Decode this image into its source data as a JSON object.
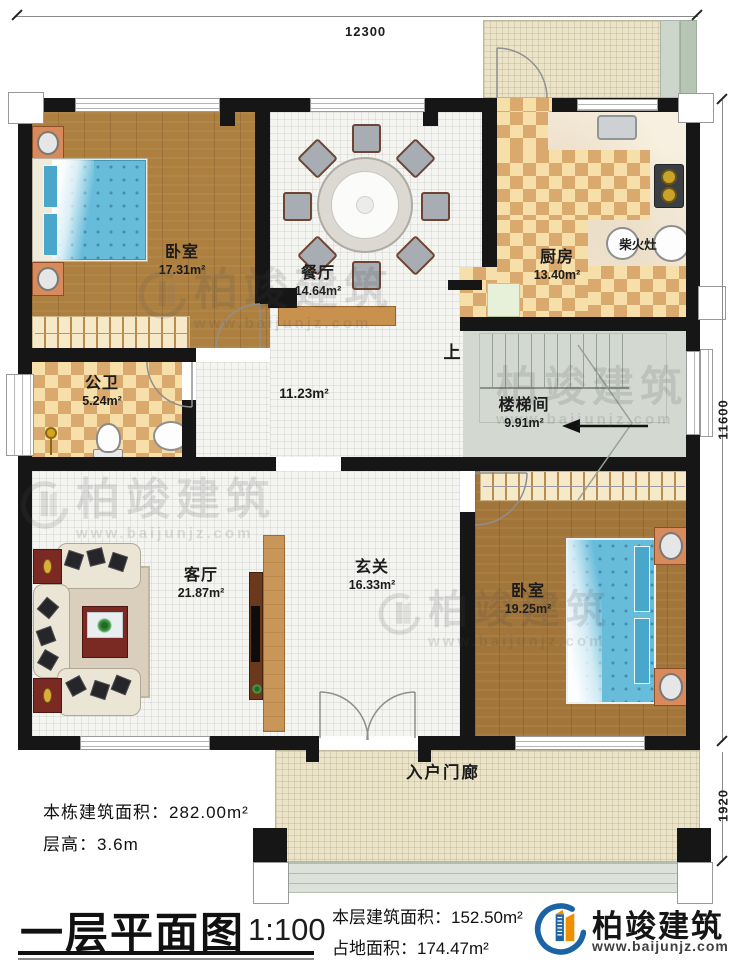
{
  "plan": {
    "dimensions": {
      "top": "12300",
      "right_upper": "11600",
      "right_lower": "1920"
    },
    "rooms": {
      "bedroom1": {
        "name": "卧室",
        "area": "17.31m²"
      },
      "dining": {
        "name": "餐厅",
        "area": "14.64m²"
      },
      "kitchen": {
        "name": "厨房",
        "area": "13.40m²"
      },
      "wood_stove": {
        "name": "柴火灶"
      },
      "bathroom": {
        "name": "公卫",
        "area": "5.24m²"
      },
      "hallway": {
        "area": "11.23m²"
      },
      "stairwell": {
        "name": "楼梯间",
        "area": "9.91m²",
        "up_label": "上"
      },
      "living": {
        "name": "客厅",
        "area": "21.87m²"
      },
      "foyer": {
        "name": "玄关",
        "area": "16.33m²"
      },
      "bedroom2": {
        "name": "卧室",
        "area": "19.25m²"
      },
      "porch": {
        "name": "入户门廊"
      }
    }
  },
  "notes": {
    "building_area": "本栋建筑面积：282.00m²",
    "floor_height": "层高：3.6m"
  },
  "title_block": {
    "title": "一层平面图",
    "scale": "1:100",
    "floor_area": "本层建筑面积：152.50m²",
    "land_area": "占地面积：174.47m²"
  },
  "brand": {
    "name": "柏竣建筑",
    "url": "www.baijunjz.com"
  },
  "watermark": {
    "name": "柏竣建筑",
    "url": "www.baijunjz.com"
  },
  "colors": {
    "wall": "#161616",
    "wood": "#ad8040",
    "checker_dark": "#d9a96e",
    "checker_light": "#f6dfa9",
    "bed_blue": "#67bcda",
    "stair_gray": "#d3d9d1",
    "brand_blue": "#1b63a5",
    "brand_orange": "#ef8f00"
  }
}
